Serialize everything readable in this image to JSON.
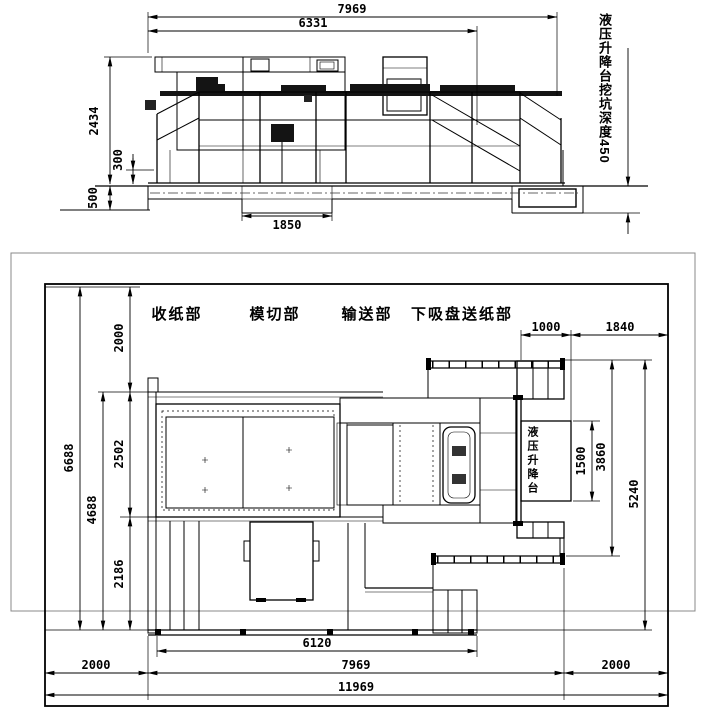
{
  "drawing": {
    "elevation": {
      "dim_total_length": "7969",
      "dim_body_length": "6331",
      "dim_height": "2434",
      "dim_base_height": "300",
      "dim_foundation_depth": "500",
      "dim_center_pit_width": "1850",
      "pit_note": "液压升降台挖坑深度450"
    },
    "plan": {
      "sections": {
        "delivery": "收纸部",
        "die_cutting": "模切部",
        "conveyor": "输送部",
        "feeder": "下吸盘送纸部"
      },
      "lift_label": "液压升降台",
      "dim_top_margin": "2000",
      "dim_site_depth": "6688",
      "dim_work_depth": "4688",
      "dim_machine_depth": "2502",
      "dim_walkway_depth": "2186",
      "dim_lift_width": "1000",
      "dim_right_top_margin": "1840",
      "dim_lift_length": "1500",
      "dim_lift_zone_depth": "3860",
      "dim_right_zone_depth": "5240",
      "dim_platform_length": "6120",
      "dim_left_margin": "2000",
      "dim_machine_length": "7969",
      "dim_right_margin": "2000",
      "dim_site_length": "11969"
    },
    "colors": {
      "hatch_yellow": "#e6e040",
      "line": "#000000",
      "sheet_border": "#888888"
    }
  }
}
